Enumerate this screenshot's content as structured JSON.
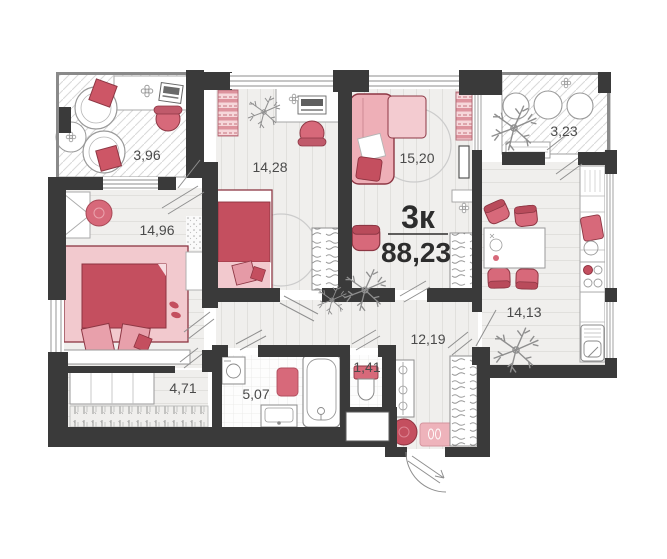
{
  "plan": {
    "apartment_type_label": "3к",
    "total_area": "88,23",
    "rooms": [
      {
        "name": "balcony-top-left",
        "area": "3,96"
      },
      {
        "name": "bedroom-2",
        "area": "14,28"
      },
      {
        "name": "living-room",
        "area": "15,20"
      },
      {
        "name": "balcony-top-right",
        "area": "3,23"
      },
      {
        "name": "bedroom-1",
        "area": "14,96"
      },
      {
        "name": "kitchen",
        "area": "14,13"
      },
      {
        "name": "hallway",
        "area": "12,19"
      },
      {
        "name": "wc",
        "area": "1,41"
      },
      {
        "name": "bathroom",
        "area": "5,07"
      },
      {
        "name": "wardrobe-corridor",
        "area": "4,71"
      }
    ],
    "colors": {
      "wall": "#3a3a3a",
      "floor": "#f0efed",
      "accent_dark": "#c44f5f",
      "accent_light": "#eeafb7",
      "label": "#4a4a4a",
      "title": "#2d2d2d"
    }
  }
}
